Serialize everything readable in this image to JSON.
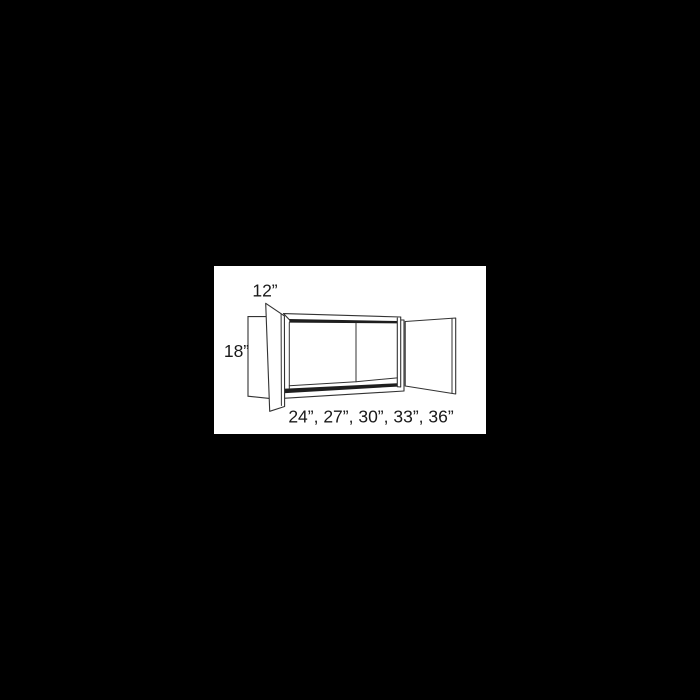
{
  "window": {
    "background_color": "#000000"
  },
  "panel": {
    "background_color": "#ffffff"
  },
  "diagram": {
    "kind": "wall-cabinet-3d-line-drawing",
    "line_color": "#333333",
    "band_color": "#1e1e1e",
    "text_color": "#1a1a1a",
    "labels": {
      "depth": "12”",
      "height": "18”",
      "widths": "24”, 27”, 30”, 33”, 36”"
    }
  }
}
